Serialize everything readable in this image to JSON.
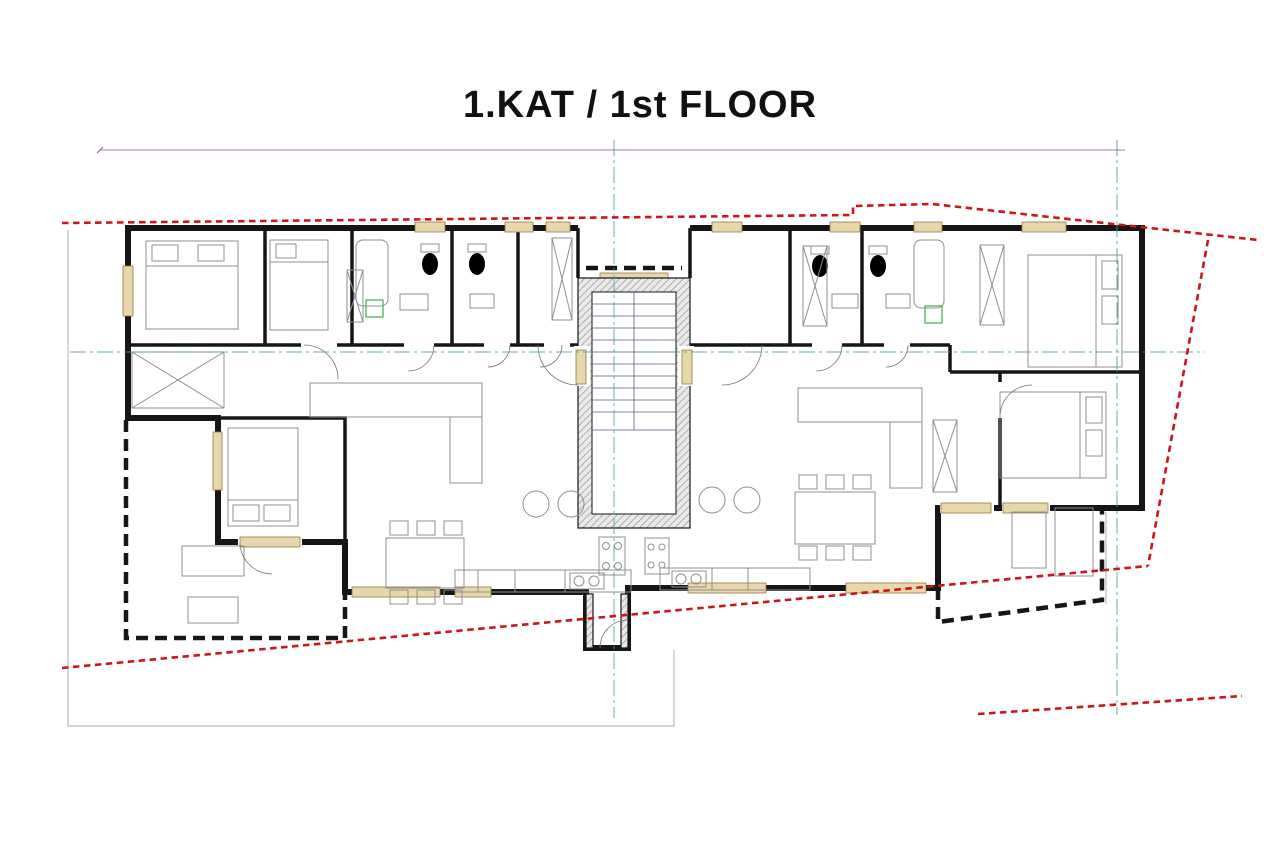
{
  "title": "1.KAT / 1st FLOOR",
  "colors": {
    "dimension": "#8a4d96",
    "boundary_red": "#cc1518",
    "axis_teal": "#42a393",
    "s3_label": "#f0b400",
    "s4_label": "#8d3597",
    "wall": "#161616",
    "window_fill": "#e8d7ad",
    "washing_machine_green": "#3fae49"
  },
  "apartments": [
    {
      "label": "S3",
      "x": 487,
      "y": 433,
      "color": "#f0b400"
    },
    {
      "label": "S4",
      "x": 737,
      "y": 433,
      "color": "#8d3597"
    }
  ],
  "rooms": [
    {
      "name": "SPAVAĆA SOBA",
      "area": "P=9,72 m²",
      "x": 205,
      "y": 288
    },
    {
      "name": "SPAVAĆA SOBA",
      "area": "P=5,05 m²",
      "x": 312,
      "y": 283
    },
    {
      "name": "KUPAONICA",
      "area": "P=4,73 m²",
      "x": 404,
      "y": 283
    },
    {
      "name": "WC",
      "area": "P=2,58 m²",
      "x": 486,
      "y": 280
    },
    {
      "name": "OSTAVA",
      "area": "P=2,80 m²",
      "x": 540,
      "y": 280
    },
    {
      "name": "HODNIK",
      "area": "P=8,08 m²",
      "x": 417,
      "y": 357
    },
    {
      "name": "STUBIŠTE",
      "area": "P=13,10 m²",
      "x": 641,
      "y": 352
    },
    {
      "name": "RADNA SOBA",
      "area": "P=5,02 m²",
      "x": 748,
      "y": 283
    },
    {
      "name": "WC",
      "area": "P=3,51 m²",
      "x": 840,
      "y": 280
    },
    {
      "name": "KUPAONICA",
      "area": "P=4,53 m²",
      "x": 922,
      "y": 280
    },
    {
      "name": "HODNIK",
      "area": "P=7,60 m²",
      "x": 843,
      "y": 358
    },
    {
      "name": "SPAVAĆA SOBA",
      "area": "P=10,72 m²",
      "x": 1062,
      "y": 298
    },
    {
      "name": "SPAVAĆA SOBA",
      "area": "P=12,04 m²",
      "x": 268,
      "y": 465
    },
    {
      "name": "TERASA",
      "area": "P=10,50 m²",
      "x": 262,
      "y": 582
    },
    {
      "name": "KUH.S BLAG. I DN BORAVKOM",
      "area": "P=32,87 m²",
      "x": 467,
      "y": 492
    },
    {
      "name": "KUH.S BLAG. I DN BORAVKOM",
      "area": "P=29,54 m²",
      "x": 780,
      "y": 480
    },
    {
      "name": "SPAVAĆA SOBA",
      "area": "P=9,41 m²",
      "x": 1068,
      "y": 440
    },
    {
      "name": "TERASA",
      "area": "P=7,32 m²",
      "x": 998,
      "y": 548
    }
  ],
  "p_labels": [
    {
      "t": "p= 100",
      "x": 148,
      "y": 268,
      "v": 1
    },
    {
      "t": "p= 120",
      "x": 340,
      "y": 241,
      "v": 0
    },
    {
      "t": "p= 120",
      "x": 432,
      "y": 241,
      "v": 0
    },
    {
      "t": "p= 120",
      "x": 515,
      "y": 241,
      "v": 0
    },
    {
      "t": "p= 120",
      "x": 757,
      "y": 247,
      "v": 0
    },
    {
      "t": "p= 120",
      "x": 852,
      "y": 248,
      "v": 0
    },
    {
      "t": "p= 100",
      "x": 660,
      "y": 296,
      "v": 0
    },
    {
      "t": "p= 100",
      "x": 1063,
      "y": 250,
      "v": 0
    },
    {
      "t": "p=0",
      "x": 201,
      "y": 447,
      "v": 1
    },
    {
      "t": "p=0",
      "x": 345,
      "y": 556,
      "v": 1
    },
    {
      "t": "p= 100",
      "x": 372,
      "y": 600,
      "v": 0
    },
    {
      "t": "p= 100",
      "x": 848,
      "y": 578,
      "v": 0
    },
    {
      "t": "p= 0",
      "x": 987,
      "y": 490,
      "v": 0
    },
    {
      "t": "p= 0",
      "x": 920,
      "y": 554,
      "v": 1
    }
  ],
  "openings": [
    {
      "a": "70",
      "b": "100",
      "x": 428,
      "y": 212,
      "o": "v"
    },
    {
      "a": "70",
      "b": "100",
      "x": 519,
      "y": 212,
      "o": "v"
    },
    {
      "a": "70",
      "b": "100",
      "x": 558,
      "y": 212,
      "o": "v"
    },
    {
      "a": "160",
      "b": "170",
      "x": 641,
      "y": 256,
      "o": "v"
    },
    {
      "a": "70",
      "b": "100",
      "x": 727,
      "y": 212,
      "o": "v"
    },
    {
      "a": "70",
      "b": "100",
      "x": 845,
      "y": 209,
      "o": "v"
    },
    {
      "a": "70",
      "b": "100",
      "x": 929,
      "y": 207,
      "o": "v"
    },
    {
      "a": "160",
      "b": "120",
      "x": 1040,
      "y": 213,
      "o": "v"
    },
    {
      "a": "160",
      "b": "220",
      "x": 100,
      "y": 292,
      "o": "h"
    },
    {
      "a": "90",
      "b": "210",
      "x": 235,
      "y": 347,
      "o": "h"
    },
    {
      "a": "90",
      "b": "210",
      "x": 307,
      "y": 404,
      "o": "h"
    },
    {
      "a": "80",
      "b": "210",
      "x": 424,
      "y": 297,
      "o": "h"
    },
    {
      "a": "70",
      "b": "210",
      "x": 497,
      "y": 298,
      "o": "h"
    },
    {
      "a": "70",
      "b": "210",
      "x": 536,
      "y": 298,
      "o": "h"
    },
    {
      "a": "100",
      "b": "220",
      "x": 545,
      "y": 358,
      "o": "h"
    },
    {
      "a": "100",
      "b": "220",
      "x": 700,
      "y": 358,
      "o": "h"
    },
    {
      "a": "70",
      "b": "210",
      "x": 815,
      "y": 300,
      "o": "h"
    },
    {
      "a": "70",
      "b": "210",
      "x": 886,
      "y": 300,
      "o": "h"
    },
    {
      "a": "80",
      "b": "210",
      "x": 950,
      "y": 300,
      "o": "h"
    },
    {
      "a": "90",
      "b": "210",
      "x": 1004,
      "y": 348,
      "o": "h"
    },
    {
      "a": "90",
      "b": "210",
      "x": 930,
      "y": 389,
      "o": "h"
    },
    {
      "a": "160",
      "b": "220",
      "x": 160,
      "y": 468,
      "o": "h"
    },
    {
      "a": "155",
      "b": "220",
      "x": 300,
      "y": 570,
      "o": "h"
    },
    {
      "a": "160",
      "b": "220",
      "x": 953,
      "y": 538,
      "o": "h"
    },
    {
      "a": "160",
      "b": "220",
      "x": 1008,
      "y": 524,
      "o": "h"
    },
    {
      "a": "260",
      "b": "120",
      "x": 404,
      "y": 629,
      "o": "v"
    },
    {
      "a": "260",
      "b": "120",
      "x": 742,
      "y": 634,
      "o": "v"
    }
  ],
  "kitchen_labels": [
    {
      "t": "F",
      "x": 492,
      "y": 584
    },
    {
      "t": "DW",
      "x": 540,
      "y": 584
    },
    {
      "t": "DW",
      "x": 727,
      "y": 582
    },
    {
      "t": "F",
      "x": 762,
      "y": 582
    }
  ],
  "wm_labels": [
    {
      "t": "W",
      "x": 374,
      "y": 311
    },
    {
      "t": "W",
      "x": 933,
      "y": 317
    }
  ],
  "dimensions": {
    "top": [
      {
        "y": 150,
        "x1": 100,
        "x2": 1125,
        "vals": [
          "2,450"
        ]
      },
      {
        "y": 162,
        "x1": 100,
        "x2": 1125,
        "vals": [
          "1,120",
          "220",
          "1,110"
        ]
      },
      {
        "y": 174,
        "x1": 100,
        "x2": 1125,
        "vals": [
          "35",
          "290",
          "25",
          "235",
          "10",
          "220",
          "10",
          "120",
          "10",
          "130",
          "32",
          "220",
          "32",
          "257",
          "10",
          "180",
          "10",
          "233",
          "10",
          "340",
          "35"
        ]
      },
      {
        "y": 186,
        "x1": 100,
        "x2": 1125,
        "vals": [
          "450",
          "70",
          "175",
          "70",
          "100",
          "70",
          "30",
          "70",
          "85",
          "220",
          "95",
          "70",
          "197",
          "70",
          "123",
          "70",
          "200",
          "160",
          "125"
        ]
      }
    ],
    "bottom": [
      {
        "y": 662,
        "x1": 100,
        "x2": 1125,
        "vals": [
          "135",
          "345",
          "35",
          "260",
          "257",
          "120",
          "95",
          "67",
          "120",
          "178",
          "63",
          "260",
          "35",
          "80",
          "160",
          "140",
          "100"
        ]
      },
      {
        "y": 676,
        "x1": 100,
        "x2": 1125,
        "vals": [
          "35",
          "100",
          "35",
          "310",
          "10",
          "25",
          "697",
          "35",
          "330",
          "25",
          "10",
          "322",
          "25",
          "10",
          "345",
          "35",
          "65",
          "35"
        ]
      },
      {
        "y": 690,
        "x1": 100,
        "x2": 1125,
        "vals": [
          "135",
          "345",
          "767",
          "335",
          "388",
          "380",
          "100"
        ]
      },
      {
        "y": 705,
        "x1": 100,
        "x2": 1125,
        "vals": [
          "2,450"
        ]
      }
    ],
    "left": [
      {
        "x": 90,
        "y1": 222,
        "y2": 650,
        "vals": [
          "966"
        ]
      },
      {
        "x": 103,
        "y1": 222,
        "y2": 650,
        "vals": [
          "405",
          "370",
          "191",
          "59"
        ]
      },
      {
        "x": 116,
        "y1": 222,
        "y2": 650,
        "vals": [
          "35",
          "90",
          "335",
          "135",
          "25",
          "110",
          "160",
          "100",
          "35",
          "155",
          "59"
        ]
      }
    ],
    "right": [
      {
        "x": 1150,
        "y1": 222,
        "y2": 650,
        "vals": [
          "20",
          "385",
          "25",
          "290",
          "35",
          "160",
          "49",
          "25",
          "35"
        ]
      },
      {
        "x": 1163,
        "y1": 222,
        "y2": 650,
        "vals": [
          "20",
          "315",
          "25",
          "255",
          "35",
          "180",
          "35",
          "31",
          "25"
        ]
      },
      {
        "x": 1177,
        "y1": 222,
        "y2": 650,
        "vals": [
          "931"
        ]
      }
    ],
    "inner": [
      {
        "y": 457,
        "x1": 122,
        "x2": 1148,
        "vals": [
          "345",
          "25",
          "570",
          "33",
          "226",
          "32",
          "560",
          "25",
          "353",
          "35"
        ]
      }
    ],
    "loose": [
      {
        "t": "215",
        "x": 292,
        "y": 278,
        "v": 1
      },
      {
        "t": "215",
        "x": 388,
        "y": 278,
        "v": 1
      },
      {
        "t": "195",
        "x": 787,
        "y": 277,
        "v": 1
      },
      {
        "t": "315",
        "x": 1044,
        "y": 300,
        "v": 1
      },
      {
        "t": "480",
        "x": 791,
        "y": 478,
        "v": 1
      },
      {
        "t": "536",
        "x": 392,
        "y": 496,
        "v": 1
      },
      {
        "t": "265",
        "x": 1046,
        "y": 436,
        "v": 1
      },
      {
        "t": "110",
        "x": 293,
        "y": 360,
        "v": 1
      },
      {
        "t": "110",
        "x": 790,
        "y": 360,
        "v": 1
      },
      {
        "t": "345",
        "x": 230,
        "y": 454,
        "v": 0
      }
    ]
  }
}
